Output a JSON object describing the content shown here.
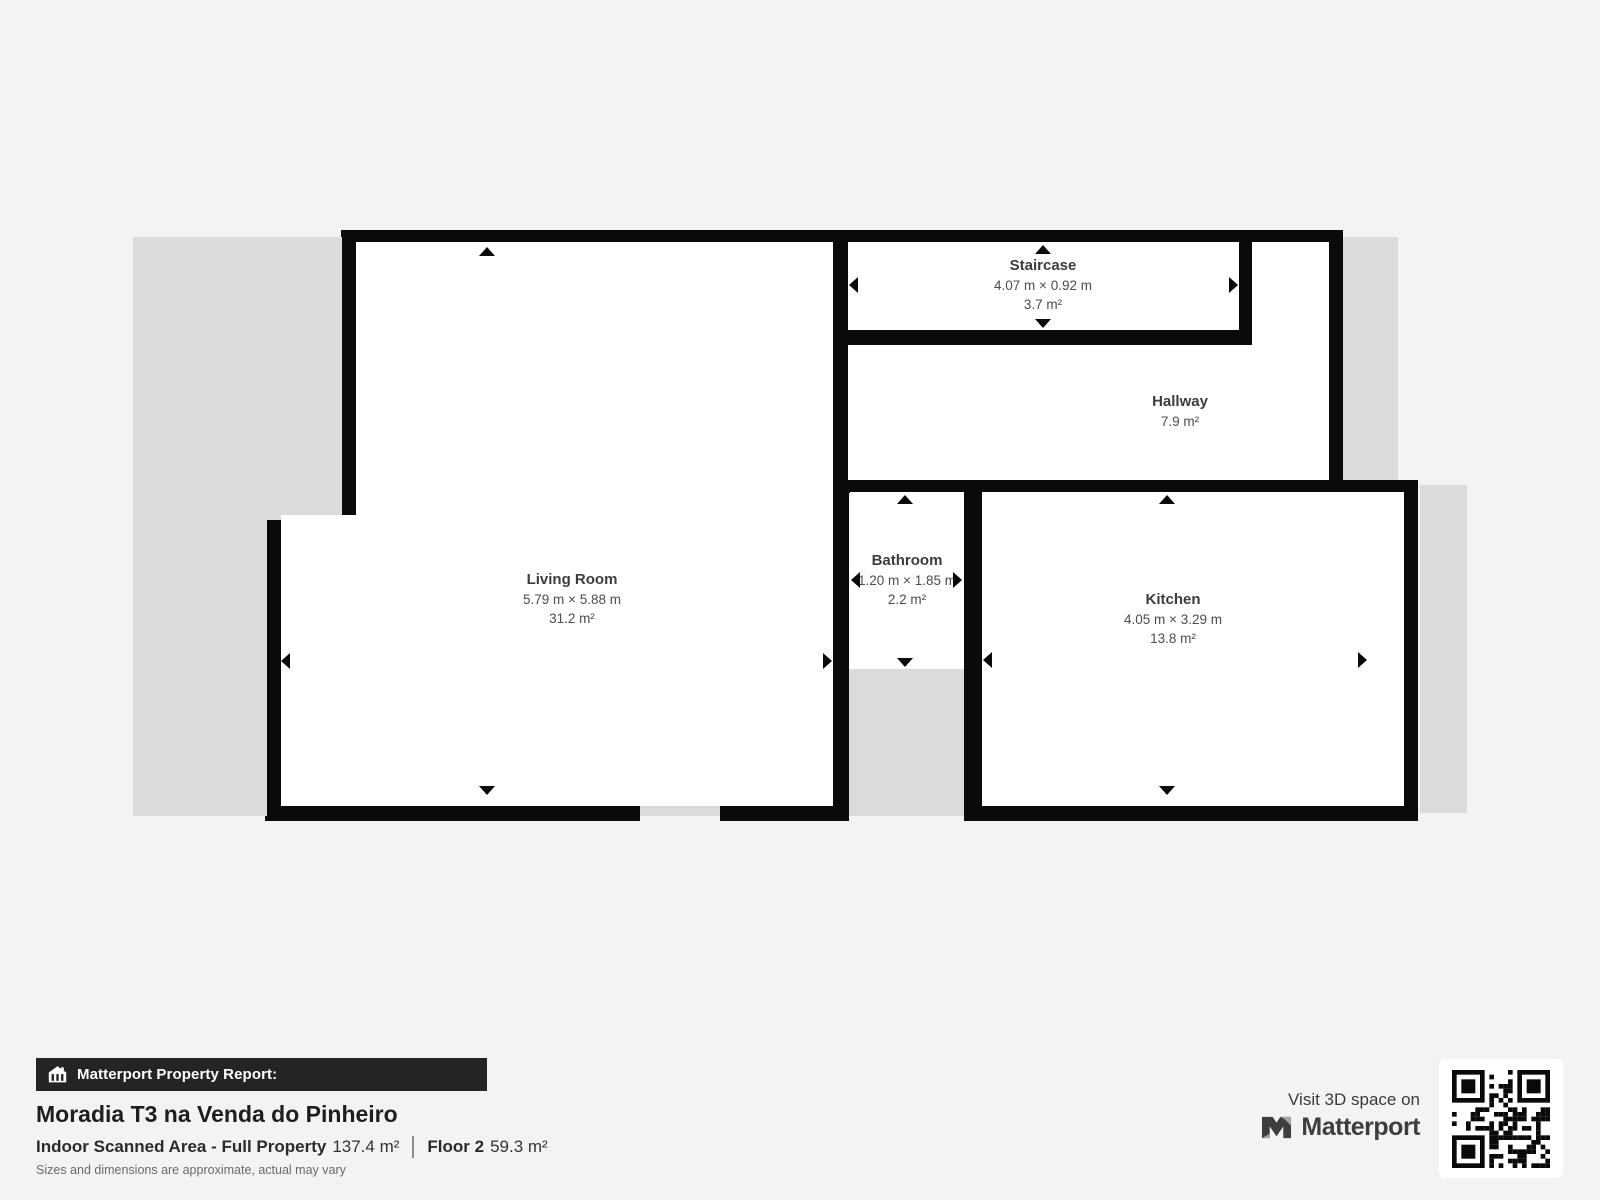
{
  "plan": {
    "rooms": [
      {
        "name": "Staircase",
        "dimensions": "4.07 m × 0.92 m",
        "area": "3.7 m²"
      },
      {
        "name": "Hallway",
        "dimensions": "",
        "area": "7.9 m²"
      },
      {
        "name": "Living Room",
        "dimensions": "5.79 m × 5.88 m",
        "area": "31.2 m²"
      },
      {
        "name": "Bathroom",
        "dimensions": "1.20 m × 1.85 m",
        "area": "2.2 m²"
      },
      {
        "name": "Kitchen",
        "dimensions": "4.05 m × 3.29 m",
        "area": "13.8 m²"
      }
    ]
  },
  "report": {
    "badge": "Matterport Property Report:",
    "property_title": "Moradia T3 na Venda do Pinheiro",
    "indoor_area_label": "Indoor Scanned Area - Full Property",
    "indoor_area_value": "137.4 m²",
    "floor_label": "Floor 2",
    "floor_value": "59.3 m²",
    "disclaimer": "Sizes and dimensions are approximate, actual may vary"
  },
  "footer_right": {
    "visit_text": "Visit 3D space on",
    "brand": "Matterport"
  },
  "colors": {
    "background": "#f3f3f1",
    "void_gray": "#dbdbdb",
    "wall_black": "#0a0a0a",
    "label_dark": "#3c3c3c",
    "badge_bg": "#252423"
  }
}
